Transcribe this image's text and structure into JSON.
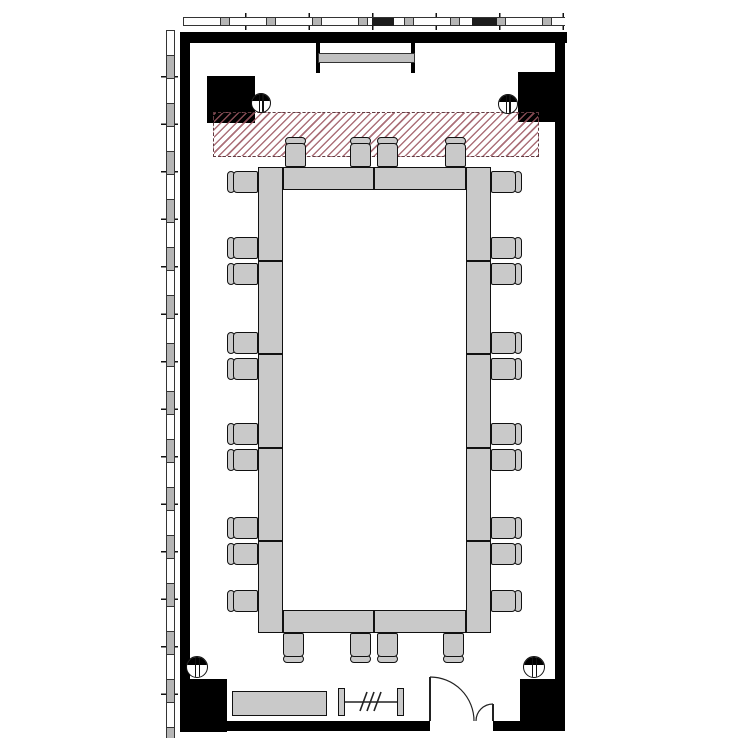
{
  "page": {
    "title": "Conference room floor plan",
    "background": "#ffffff"
  },
  "colors": {
    "wall": "#000000",
    "furniture_fill": "#c9c9c9",
    "outline": "#111111",
    "hatch_stripe": "#9e5862",
    "hatch_border": "#5f3a40",
    "mullion_gray": "#b5b5b5"
  },
  "floorplan": {
    "counts": {
      "chairs_total": 28,
      "chairs_top": 4,
      "chairs_bottom": 4,
      "chairs_left": 10,
      "chairs_right": 10,
      "structural_columns": 4,
      "round_columns": 4
    },
    "hatch_zone": {
      "x": 213,
      "y": 112,
      "w": 326,
      "h": 45
    },
    "wall_screen": {
      "caps_x": [
        316,
        411
      ],
      "cap_y": 43,
      "cap_w": 4,
      "cap_h": 30,
      "bar": {
        "x": 318,
        "y": 53,
        "w": 97,
        "h": 10
      }
    },
    "columns": [
      {
        "x": 207,
        "y": 76,
        "w": 48,
        "h": 47
      },
      {
        "x": 518,
        "y": 72,
        "w": 37,
        "h": 50
      },
      {
        "x": 180,
        "y": 679,
        "w": 47,
        "h": 53
      },
      {
        "x": 520,
        "y": 679,
        "w": 45,
        "h": 51
      }
    ],
    "round_columns": [
      {
        "cx": 261,
        "cy": 103,
        "r": 10
      },
      {
        "cx": 508,
        "cy": 104,
        "r": 10
      },
      {
        "cx": 197,
        "cy": 667,
        "r": 11
      },
      {
        "cx": 534,
        "cy": 667,
        "r": 11
      }
    ],
    "table": {
      "x": 258,
      "y": 167,
      "w": 233,
      "h": 466,
      "side_band_w": 25,
      "end_band_h": 23,
      "row_dividers_y": [
        260,
        353,
        447,
        540
      ],
      "col_divider_x": 373
    },
    "chairs": {
      "top_x": [
        285,
        350,
        377,
        445
      ],
      "bottom_x": [
        283,
        350,
        377,
        443
      ],
      "side_y": [
        171,
        237,
        263,
        332,
        358,
        423,
        449,
        517,
        543,
        590
      ],
      "top_row_y": 137,
      "bottom_row_y": 633,
      "left_col_x": 227,
      "right_col_x": 491
    },
    "credenza": {
      "x": 232,
      "y": 691,
      "w": 95,
      "h": 25
    },
    "rail": {
      "posts_x": [
        338,
        397
      ],
      "y": 688,
      "post_w": 7,
      "post_h": 28,
      "line_y": 702,
      "slash_count": 3,
      "slash_start_x": 360
    },
    "door": {
      "sill_y": 721,
      "opening_x": [
        430,
        493
      ],
      "leaf_main_r": 44,
      "leaf_small_r": 17
    },
    "strip_dark_segments": [
      {
        "x": 372,
        "w": 22
      },
      {
        "x": 472,
        "w": 25
      }
    ]
  }
}
